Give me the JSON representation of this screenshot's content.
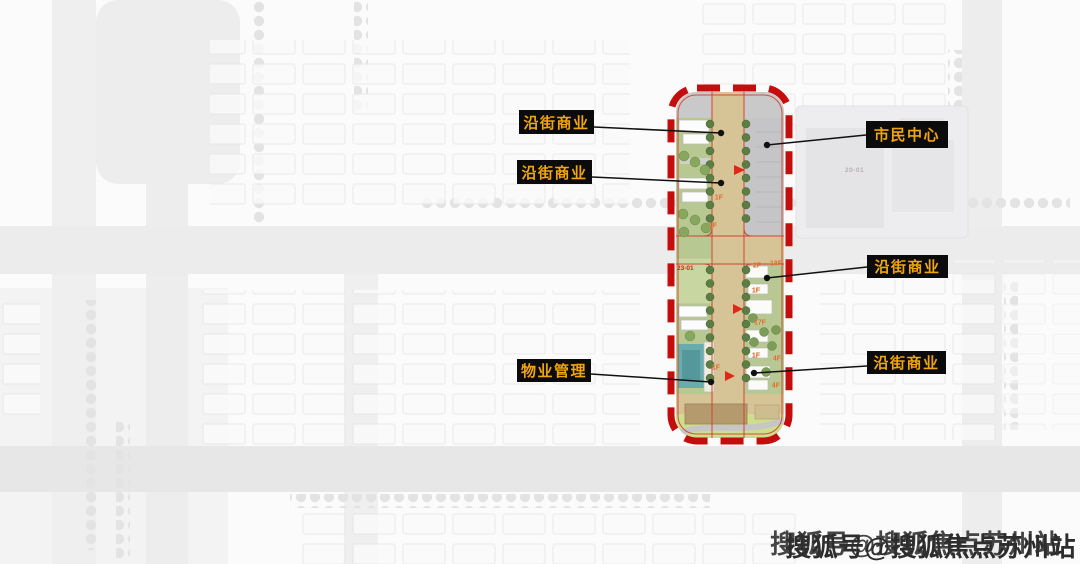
{
  "callouts": [
    {
      "id": "yanjie-shangye-1",
      "text": "沿街商业",
      "box": {
        "x": 519,
        "y": 110,
        "w": 75,
        "h": 24
      },
      "from": {
        "x": 594,
        "y": 127
      },
      "dot": {
        "x": 721,
        "y": 133
      }
    },
    {
      "id": "yanjie-shangye-2",
      "text": "沿街商业",
      "box": {
        "x": 517,
        "y": 160,
        "w": 75,
        "h": 24
      },
      "from": {
        "x": 592,
        "y": 177
      },
      "dot": {
        "x": 721,
        "y": 183
      }
    },
    {
      "id": "shimin-zhongxin",
      "text": "市民中心",
      "box": {
        "x": 866,
        "y": 121,
        "w": 82,
        "h": 27
      },
      "from": {
        "x": 866,
        "y": 135
      },
      "dot": {
        "x": 767,
        "y": 145
      }
    },
    {
      "id": "yanjie-shangye-3",
      "text": "沿街商业",
      "box": {
        "x": 867,
        "y": 255,
        "w": 81,
        "h": 23
      },
      "from": {
        "x": 867,
        "y": 267
      },
      "dot": {
        "x": 767,
        "y": 278
      }
    },
    {
      "id": "yanjie-shangye-4",
      "text": "沿街商业",
      "box": {
        "x": 867,
        "y": 351,
        "w": 79,
        "h": 23
      },
      "from": {
        "x": 867,
        "y": 366
      },
      "dot": {
        "x": 754,
        "y": 373
      }
    },
    {
      "id": "wuye-guanli",
      "text": "物业管理",
      "box": {
        "x": 517,
        "y": 359,
        "w": 74,
        "h": 23
      },
      "from": {
        "x": 591,
        "y": 374
      },
      "dot": {
        "x": 711,
        "y": 382
      }
    }
  ],
  "plan": {
    "parcel_label": {
      "text": "23-01"
    },
    "background_parcel": {
      "text": "20-01"
    },
    "floor_tags": [
      {
        "text": "1F",
        "x": 719,
        "y": 198
      },
      {
        "text": "1F",
        "x": 713,
        "y": 226
      },
      {
        "text": "1F",
        "x": 716,
        "y": 368
      },
      {
        "text": "2F",
        "x": 757,
        "y": 266
      },
      {
        "text": "18F",
        "x": 776,
        "y": 264
      },
      {
        "text": "1F",
        "x": 756,
        "y": 291
      },
      {
        "text": "17F",
        "x": 760,
        "y": 323
      },
      {
        "text": "1F",
        "x": 756,
        "y": 356
      },
      {
        "text": "4F",
        "x": 777,
        "y": 359
      },
      {
        "text": "4F",
        "x": 776,
        "y": 386
      }
    ]
  },
  "watermark": {
    "text": "搜狐号@搜狐焦点苏州站"
  },
  "colors": {
    "boundary_red": "#c40d0d",
    "callout_bg": "#0b0b0b",
    "callout_text": "#f0a50a",
    "road_tan": "#d6c396",
    "lawn_green": "#b7c892",
    "field_green": "#c8d7a2",
    "strip_green": "#cede8d",
    "plaza_gray": "#c5c4c6",
    "pool_teal": "#6aabad",
    "tree_green": "#5c7d44",
    "floor_tag_orange": "#d9641e",
    "watermark_gray": "#2d2d2d"
  }
}
